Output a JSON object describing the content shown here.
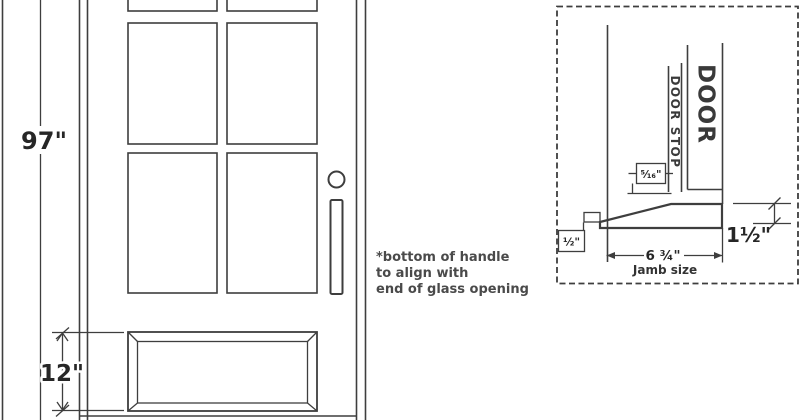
{
  "colors": {
    "background": "#ffffff",
    "line": "#3e3e3e",
    "dimension_text": "#262626",
    "note_text": "#4a4a4a"
  },
  "elevation": {
    "height_dim_label": "97\"",
    "bottom_rail_dim_label": "12\"",
    "handle_note": {
      "line1": "*bottom of handle",
      "line2": "to align with",
      "line3": "end of glass opening"
    }
  },
  "detail": {
    "door_label": "DOOR",
    "door_stop_label": "DOOR STOP",
    "door_stop_width_label": "⁵⁄₁₆\"",
    "threshold_height_label": "1½\"",
    "sill_nosing_label": "½\"",
    "jamb_size_label": "6 ¾\"",
    "jamb_size_caption": "Jamb size"
  }
}
